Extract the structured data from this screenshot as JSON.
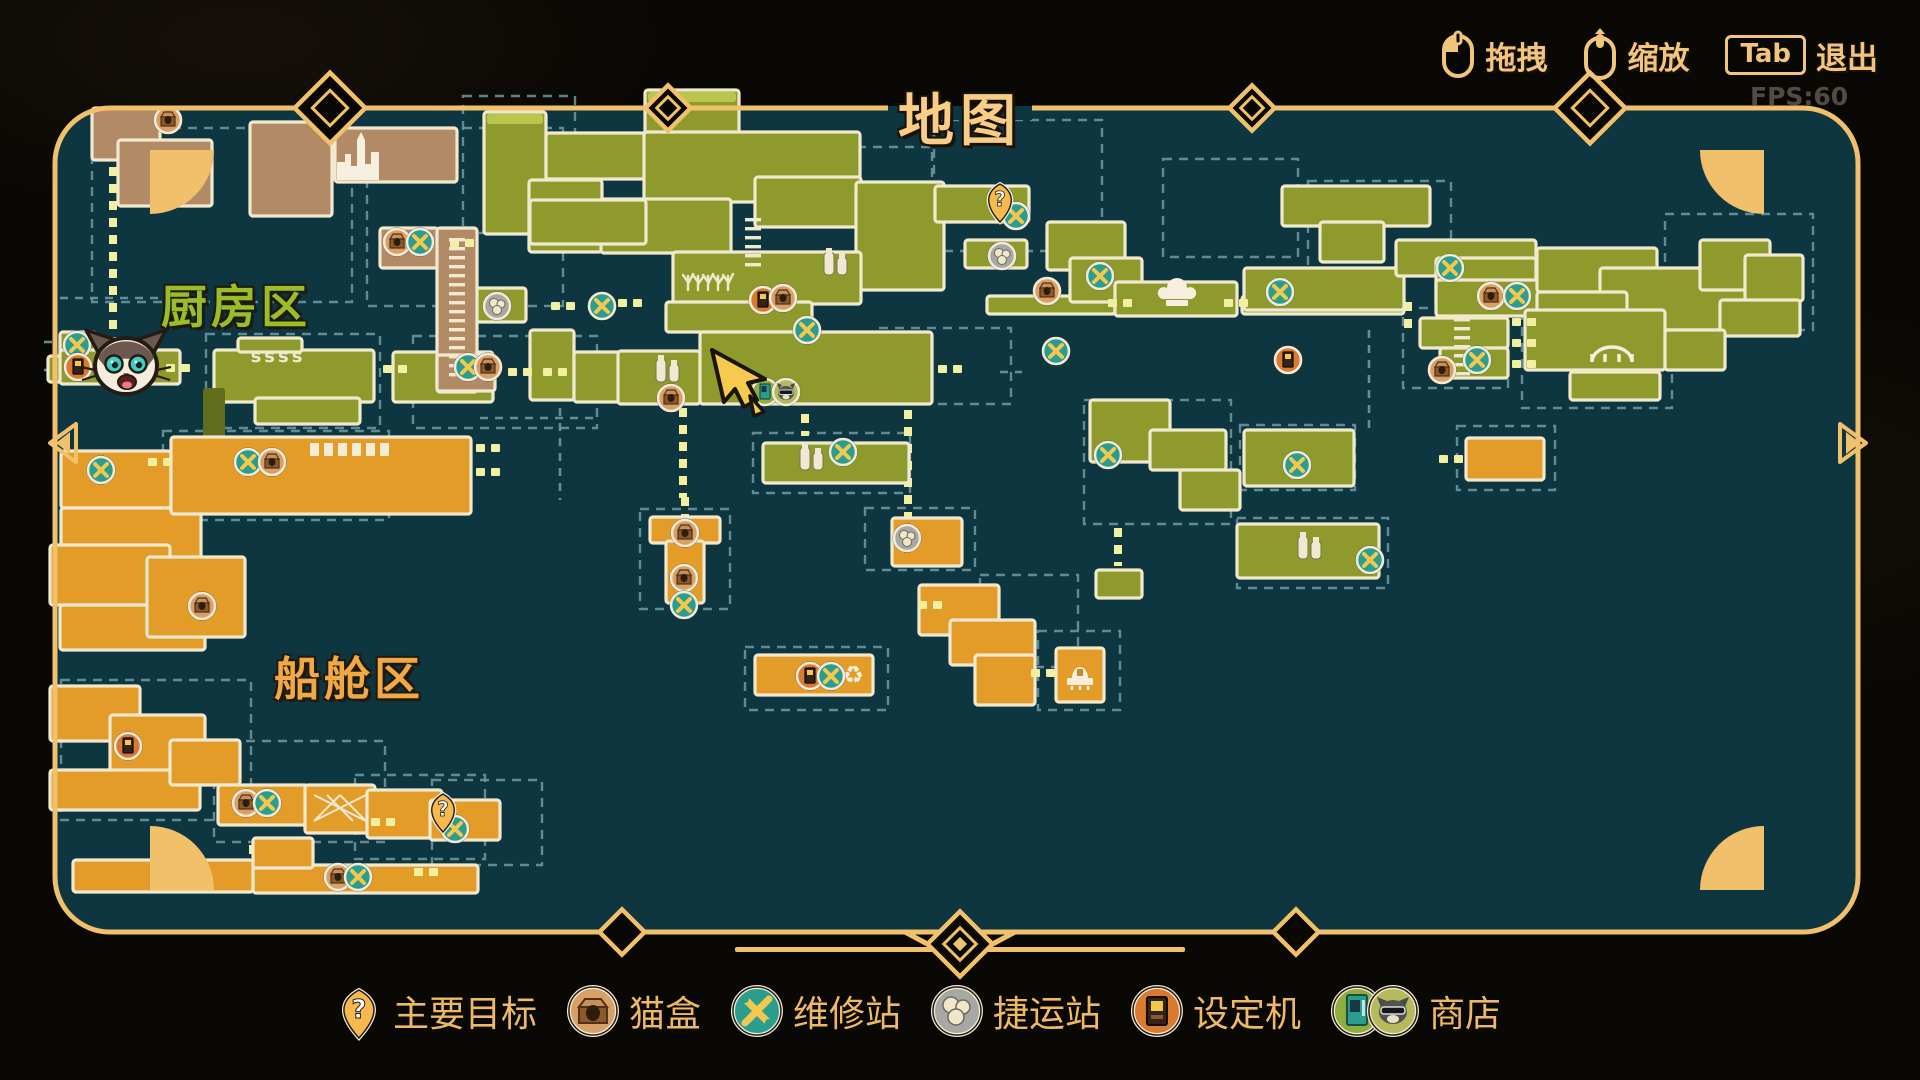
{
  "header": {
    "title": "地图",
    "fps": "FPS:60",
    "controls": [
      {
        "icon": "mouse-drag-icon",
        "label": "拖拽"
      },
      {
        "icon": "mouse-zoom-icon",
        "label": "缩放"
      },
      {
        "icon": "tab-key",
        "key": "Tab",
        "label": "退出"
      }
    ]
  },
  "legend": {
    "items": [
      {
        "type": "objective",
        "label": "主要目标"
      },
      {
        "type": "catbox",
        "label": "猫盒"
      },
      {
        "type": "repair",
        "label": "维修站"
      },
      {
        "type": "transit",
        "label": "捷运站"
      },
      {
        "type": "arcade",
        "label": "设定机"
      },
      {
        "type": "shop",
        "label": "商店"
      }
    ]
  },
  "theme": {
    "gold": "#f0c06a",
    "text_gold": "#f2c57c",
    "map_bg": "#0e3641",
    "green": "#8e9b2c",
    "green_moss": "#b9c64e",
    "orange": "#e39c28",
    "brown": "#b28a66",
    "shaft": "#5f6d1d",
    "cream": "#f0e9ce",
    "box_dash": "#6f99a3",
    "door": "#f2efa0",
    "teal_marker": "#2a9d8f",
    "tan_marker": "#d9a066",
    "gray_marker": "#a8a8a3",
    "orange_marker": "#d97a2e",
    "shop_green": "#8fae3f",
    "shop_olive": "#b5ba5c",
    "pin": "#f5b94e",
    "wrench": "#f3c84f"
  },
  "map": {
    "regions": [
      {
        "id": "kitchen",
        "label": "厨房区",
        "x": 236,
        "y": 304,
        "color": "#9cbd2a"
      },
      {
        "id": "cabin",
        "label": "船舱区",
        "x": 349,
        "y": 676,
        "color": "#f0a944"
      }
    ],
    "rooms": [
      [
        484,
        112,
        62,
        122,
        "g",
        "m"
      ],
      [
        546,
        133,
        180,
        46,
        "g"
      ],
      [
        645,
        90,
        94,
        44,
        "g",
        "m"
      ],
      [
        644,
        132,
        216,
        70,
        "g"
      ],
      [
        529,
        180,
        73,
        72,
        "g"
      ],
      [
        601,
        199,
        130,
        54,
        "g"
      ],
      [
        530,
        200,
        116,
        44,
        "g"
      ],
      [
        755,
        177,
        106,
        50,
        "g"
      ],
      [
        856,
        182,
        88,
        108,
        "g"
      ],
      [
        673,
        252,
        188,
        52,
        "g"
      ],
      [
        666,
        302,
        146,
        30,
        "g"
      ],
      [
        530,
        330,
        44,
        70,
        "g"
      ],
      [
        574,
        352,
        48,
        50,
        "g"
      ],
      [
        618,
        351,
        82,
        53,
        "g"
      ],
      [
        700,
        332,
        232,
        72,
        "g"
      ],
      [
        393,
        352,
        100,
        50,
        "g"
      ],
      [
        466,
        288,
        60,
        34,
        "g"
      ],
      [
        214,
        350,
        160,
        52,
        "g"
      ],
      [
        255,
        398,
        105,
        26,
        "g"
      ],
      [
        238,
        338,
        64,
        14,
        "g"
      ],
      [
        60,
        332,
        36,
        26,
        "g"
      ],
      [
        48,
        356,
        46,
        26,
        "g"
      ],
      [
        60,
        350,
        120,
        34,
        "g"
      ],
      [
        935,
        186,
        94,
        36,
        "g"
      ],
      [
        965,
        240,
        62,
        28,
        "g"
      ],
      [
        987,
        296,
        128,
        18,
        "g"
      ],
      [
        1047,
        222,
        78,
        48,
        "g"
      ],
      [
        1070,
        258,
        72,
        44,
        "g"
      ],
      [
        1115,
        282,
        122,
        34,
        "g"
      ],
      [
        1242,
        296,
        162,
        18,
        "g"
      ],
      [
        1244,
        268,
        160,
        42,
        "g"
      ],
      [
        1282,
        186,
        148,
        40,
        "g"
      ],
      [
        1320,
        222,
        64,
        40,
        "g"
      ],
      [
        1396,
        240,
        140,
        36,
        "g"
      ],
      [
        1436,
        258,
        100,
        48,
        "g"
      ],
      [
        1436,
        280,
        110,
        36,
        "g"
      ],
      [
        1537,
        248,
        120,
        44,
        "g"
      ],
      [
        1600,
        268,
        170,
        62,
        "g"
      ],
      [
        1700,
        240,
        70,
        50,
        "g"
      ],
      [
        1537,
        292,
        90,
        38,
        "g"
      ],
      [
        1745,
        255,
        58,
        46,
        "g"
      ],
      [
        1720,
        300,
        80,
        36,
        "g"
      ],
      [
        1525,
        310,
        140,
        60,
        "g"
      ],
      [
        1570,
        372,
        90,
        28,
        "g"
      ],
      [
        1665,
        330,
        60,
        40,
        "g"
      ],
      [
        1420,
        318,
        88,
        30,
        "g"
      ],
      [
        1440,
        348,
        68,
        30,
        "g"
      ],
      [
        1090,
        400,
        80,
        62,
        "g"
      ],
      [
        1150,
        430,
        76,
        40,
        "g"
      ],
      [
        1244,
        430,
        110,
        56,
        "g"
      ],
      [
        1180,
        470,
        60,
        40,
        "g"
      ],
      [
        1237,
        524,
        142,
        54,
        "g"
      ],
      [
        1096,
        570,
        46,
        28,
        "g"
      ],
      [
        763,
        443,
        146,
        40,
        "g"
      ],
      [
        203,
        388,
        22,
        92,
        "s"
      ],
      [
        92,
        108,
        68,
        52,
        "b"
      ],
      [
        118,
        140,
        94,
        66,
        "b"
      ],
      [
        250,
        122,
        82,
        94,
        "b"
      ],
      [
        335,
        128,
        122,
        54,
        "b"
      ],
      [
        380,
        228,
        58,
        40,
        "b"
      ],
      [
        437,
        228,
        40,
        164,
        "b"
      ],
      [
        437,
        355,
        58,
        36,
        "b"
      ],
      [
        61,
        451,
        110,
        57,
        "o"
      ],
      [
        61,
        508,
        140,
        50,
        "o"
      ],
      [
        171,
        437,
        300,
        77,
        "o"
      ],
      [
        50,
        545,
        120,
        60,
        "o"
      ],
      [
        60,
        605,
        145,
        45,
        "o"
      ],
      [
        147,
        557,
        98,
        80,
        "o"
      ],
      [
        650,
        517,
        70,
        26,
        "o"
      ],
      [
        666,
        541,
        38,
        62,
        "o"
      ],
      [
        755,
        655,
        118,
        40,
        "o"
      ],
      [
        892,
        518,
        70,
        48,
        "o"
      ],
      [
        919,
        585,
        80,
        50,
        "o"
      ],
      [
        950,
        620,
        85,
        45,
        "o"
      ],
      [
        975,
        655,
        60,
        50,
        "o"
      ],
      [
        1056,
        648,
        48,
        54,
        "o"
      ],
      [
        1466,
        438,
        78,
        42,
        "o"
      ],
      [
        50,
        686,
        90,
        55,
        "o"
      ],
      [
        110,
        715,
        95,
        60,
        "o"
      ],
      [
        50,
        770,
        150,
        40,
        "o"
      ],
      [
        170,
        740,
        70,
        45,
        "o"
      ],
      [
        218,
        785,
        90,
        40,
        "o"
      ],
      [
        305,
        785,
        70,
        48,
        "o"
      ],
      [
        367,
        790,
        75,
        48,
        "o"
      ],
      [
        430,
        800,
        70,
        40,
        "o"
      ],
      [
        73,
        860,
        180,
        32,
        "o"
      ],
      [
        253,
        865,
        225,
        28,
        "o"
      ],
      [
        253,
        838,
        60,
        30,
        "o"
      ]
    ],
    "boxes": [
      [
        92,
        128,
        260,
        174
      ],
      [
        367,
        128,
        196,
        178
      ],
      [
        463,
        96,
        112,
        137
      ],
      [
        857,
        147,
        75,
        98
      ],
      [
        934,
        120,
        168,
        131
      ],
      [
        1163,
        159,
        135,
        98
      ],
      [
        1308,
        181,
        143,
        91
      ],
      [
        206,
        334,
        174,
        94
      ],
      [
        413,
        336,
        184,
        92
      ],
      [
        879,
        328,
        132,
        76
      ],
      [
        753,
        433,
        157,
        60
      ],
      [
        1403,
        308,
        105,
        80
      ],
      [
        1522,
        300,
        150,
        108
      ],
      [
        1665,
        214,
        148,
        116
      ],
      [
        1084,
        400,
        147,
        124
      ],
      [
        1240,
        425,
        115,
        65
      ],
      [
        1237,
        518,
        151,
        70
      ],
      [
        163,
        431,
        226,
        89
      ],
      [
        980,
        575,
        98,
        92
      ],
      [
        1038,
        631,
        82,
        79
      ],
      [
        1457,
        426,
        98,
        64
      ],
      [
        61,
        680,
        190,
        140
      ],
      [
        214,
        741,
        171,
        101
      ],
      [
        355,
        775,
        130,
        84
      ],
      [
        432,
        780,
        110,
        85
      ],
      [
        640,
        509,
        90,
        100
      ],
      [
        745,
        647,
        143,
        63
      ],
      [
        865,
        508,
        110,
        62
      ]
    ],
    "gray_lines": [
      [
        60,
        298,
        206,
        298
      ],
      [
        560,
        408,
        560,
        500
      ],
      [
        1369,
        330,
        1369,
        428
      ],
      [
        1540,
        305,
        1663,
        305
      ],
      [
        60,
        523,
        165,
        523
      ],
      [
        44,
        342,
        58,
        342
      ],
      [
        44,
        370,
        58,
        370
      ],
      [
        1000,
        372,
        1022,
        372
      ],
      [
        480,
        418,
        598,
        418
      ]
    ],
    "yellow_lines": [
      [
        113,
        150,
        113,
        345
      ],
      [
        908,
        410,
        908,
        520
      ],
      [
        683,
        408,
        683,
        498
      ],
      [
        685,
        497,
        685,
        517
      ],
      [
        1118,
        528,
        1118,
        566
      ],
      [
        253,
        845,
        253,
        862
      ],
      [
        1408,
        302,
        1408,
        330
      ],
      [
        805,
        414,
        805,
        436
      ]
    ],
    "doors": [
      [
        178,
        368
      ],
      [
        395,
        369
      ],
      [
        520,
        372
      ],
      [
        555,
        372
      ],
      [
        563,
        306
      ],
      [
        630,
        303
      ],
      [
        462,
        243
      ],
      [
        950,
        369
      ],
      [
        1120,
        303
      ],
      [
        1236,
        303
      ],
      [
        1043,
        673
      ],
      [
        1451,
        459
      ],
      [
        488,
        448
      ],
      [
        488,
        472
      ],
      [
        426,
        872
      ],
      [
        383,
        822
      ],
      [
        1524,
        322
      ],
      [
        1524,
        343
      ],
      [
        1524,
        364
      ],
      [
        930,
        605
      ],
      [
        160,
        462
      ]
    ],
    "ladders": [
      [
        753,
        218,
        53
      ],
      [
        1462,
        318,
        60
      ],
      [
        457,
        238,
        140
      ]
    ],
    "icons": [
      {
        "t": "skyline",
        "x": 382,
        "y": 156
      },
      {
        "t": "steam",
        "x": 278,
        "y": 357,
        "text": "ssss"
      },
      {
        "t": "plants",
        "x": 708,
        "y": 278
      },
      {
        "t": "bottles",
        "x": 668,
        "y": 371
      },
      {
        "t": "bottles",
        "x": 836,
        "y": 264
      },
      {
        "t": "bottles",
        "x": 812,
        "y": 459
      },
      {
        "t": "bottles",
        "x": 1310,
        "y": 548
      },
      {
        "t": "chefhat",
        "x": 1177,
        "y": 296
      },
      {
        "t": "bridge",
        "x": 1612,
        "y": 352
      },
      {
        "t": "boat",
        "x": 1080,
        "y": 674
      },
      {
        "t": "windows",
        "x": 352,
        "y": 450
      },
      {
        "t": "lattice",
        "x": 340,
        "y": 808
      },
      {
        "t": "recycle",
        "x": 853,
        "y": 675
      }
    ],
    "markers": [
      {
        "t": "repair",
        "x": 77,
        "y": 345
      },
      {
        "t": "arcade",
        "x": 78,
        "y": 367
      },
      {
        "t": "transit",
        "x": 497,
        "y": 306
      },
      {
        "t": "repair",
        "x": 602,
        "y": 306
      },
      {
        "t": "repair",
        "x": 468,
        "y": 367
      },
      {
        "t": "catbox",
        "x": 488,
        "y": 367
      },
      {
        "t": "arcade",
        "x": 763,
        "y": 300
      },
      {
        "t": "catbox",
        "x": 783,
        "y": 298
      },
      {
        "t": "repair",
        "x": 807,
        "y": 330
      },
      {
        "t": "catbox",
        "x": 671,
        "y": 398
      },
      {
        "t": "shop",
        "x": 775,
        "y": 392
      },
      {
        "t": "repair",
        "x": 843,
        "y": 452
      },
      {
        "t": "repair",
        "x": 1016,
        "y": 216
      },
      {
        "t": "transit",
        "x": 1002,
        "y": 256
      },
      {
        "t": "repair",
        "x": 1100,
        "y": 276
      },
      {
        "t": "repair",
        "x": 1280,
        "y": 292
      },
      {
        "t": "catbox",
        "x": 1047,
        "y": 291
      },
      {
        "t": "repair",
        "x": 1056,
        "y": 351
      },
      {
        "t": "repair",
        "x": 1450,
        "y": 268
      },
      {
        "t": "catbox",
        "x": 1491,
        "y": 296
      },
      {
        "t": "repair",
        "x": 1517,
        "y": 296
      },
      {
        "t": "arcade",
        "x": 1288,
        "y": 360
      },
      {
        "t": "catbox",
        "x": 1442,
        "y": 370
      },
      {
        "t": "repair",
        "x": 1477,
        "y": 360
      },
      {
        "t": "repair",
        "x": 1108,
        "y": 455
      },
      {
        "t": "repair",
        "x": 1297,
        "y": 465
      },
      {
        "t": "repair",
        "x": 1370,
        "y": 560
      },
      {
        "t": "catbox",
        "x": 168,
        "y": 120
      },
      {
        "t": "catbox",
        "x": 397,
        "y": 242
      },
      {
        "t": "repair",
        "x": 420,
        "y": 242
      },
      {
        "t": "repair",
        "x": 248,
        "y": 462
      },
      {
        "t": "catbox",
        "x": 272,
        "y": 462
      },
      {
        "t": "repair",
        "x": 101,
        "y": 470
      },
      {
        "t": "catbox",
        "x": 202,
        "y": 606
      },
      {
        "t": "catbox",
        "x": 685,
        "y": 533
      },
      {
        "t": "catbox",
        "x": 684,
        "y": 578
      },
      {
        "t": "repair",
        "x": 684,
        "y": 605
      },
      {
        "t": "arcade",
        "x": 810,
        "y": 676
      },
      {
        "t": "repair",
        "x": 831,
        "y": 676
      },
      {
        "t": "transit",
        "x": 907,
        "y": 538
      },
      {
        "t": "arcade",
        "x": 128,
        "y": 746
      },
      {
        "t": "catbox",
        "x": 246,
        "y": 803
      },
      {
        "t": "repair",
        "x": 267,
        "y": 803
      },
      {
        "t": "catbox",
        "x": 338,
        "y": 877
      },
      {
        "t": "repair",
        "x": 358,
        "y": 877
      },
      {
        "t": "repair",
        "x": 455,
        "y": 829
      }
    ],
    "pins": [
      {
        "x": 1000,
        "y": 200,
        "glyph": "?"
      },
      {
        "x": 443,
        "y": 810,
        "glyph": "?"
      }
    ],
    "player": {
      "x": 126,
      "y": 366
    },
    "cursor": {
      "x": 712,
      "y": 350
    }
  }
}
